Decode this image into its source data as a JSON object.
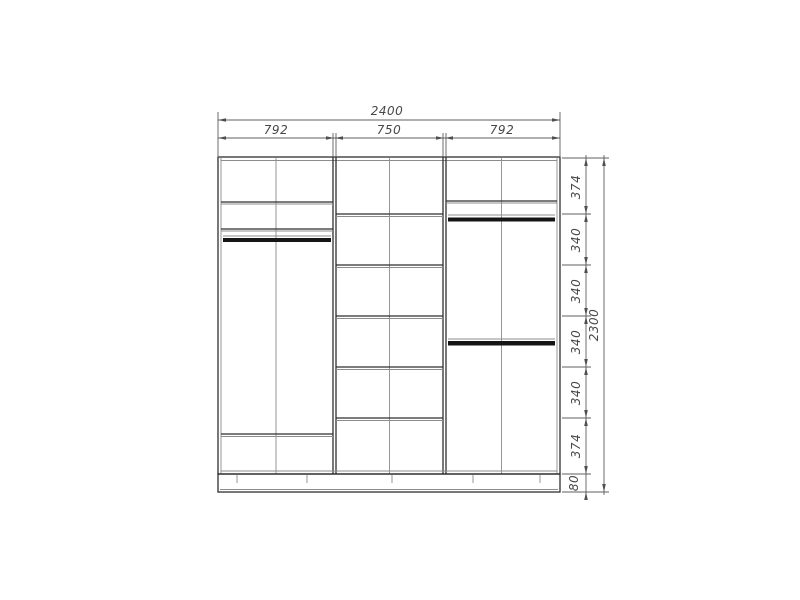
{
  "drawing": {
    "type": "wardrobe-front-elevation",
    "background": "#ffffff",
    "line_color": "#2f2f2f",
    "dim_color": "#5f5f5f",
    "dimensions": {
      "total_width": "2400",
      "section_widths": [
        "792",
        "750",
        "792"
      ],
      "height_segments": [
        "374",
        "340",
        "340",
        "340",
        "340",
        "374"
      ],
      "plinth_height": "80",
      "total_height": "2300"
    }
  }
}
